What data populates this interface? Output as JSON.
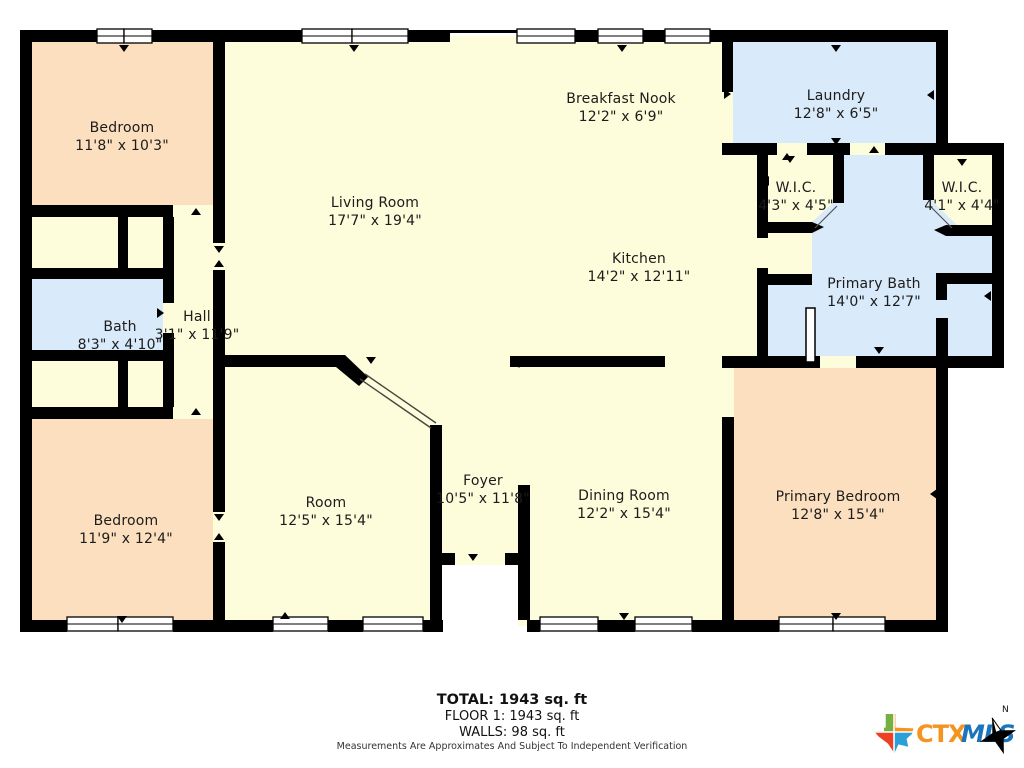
{
  "floorplan": {
    "rooms": [
      {
        "name": "Bedroom",
        "dims": "11'8\" x 10'3\""
      },
      {
        "name": "Living Room",
        "dims": "17'7\" x 19'4\""
      },
      {
        "name": "Breakfast Nook",
        "dims": "12'2\" x 6'9\""
      },
      {
        "name": "Laundry",
        "dims": "12'8\" x 6'5\""
      },
      {
        "name": "W.I.C.",
        "dims": "4'3\" x 4'5\""
      },
      {
        "name": "W.I.C.",
        "dims": "4'1\" x 4'4\""
      },
      {
        "name": "Kitchen",
        "dims": "14'2\" x 12'11\""
      },
      {
        "name": "Primary Bath",
        "dims": "14'0\" x 12'7\""
      },
      {
        "name": "Bath",
        "dims": "8'3\" x 4'10\""
      },
      {
        "name": "Hall",
        "dims": "3'1\" x 11'9\""
      },
      {
        "name": "Bedroom",
        "dims": "11'9\" x 12'4\""
      },
      {
        "name": "Room",
        "dims": "12'5\" x 15'4\""
      },
      {
        "name": "Foyer",
        "dims": "10'5\" x 11'8\""
      },
      {
        "name": "Dining Room",
        "dims": "12'2\" x 15'4\""
      },
      {
        "name": "Primary Bedroom",
        "dims": "12'8\" x 15'4\""
      }
    ],
    "footer": {
      "total": "TOTAL: 1943 sq. ft",
      "floor": "FLOOR 1: 1943 sq. ft",
      "walls": "WALLS: 98 sq. ft",
      "disclaimer": "Measurements Are Approximates And Subject To Independent Verification"
    },
    "logo": {
      "ctx": "CTX",
      "mls": "MLS",
      "north": "N"
    },
    "colors": {
      "room_cream": "#fdfcdb",
      "room_peach": "#fcdfbe",
      "room_blue": "#d9eafa",
      "wall": "#000000",
      "text": "#1c1c1c",
      "logo_orange": "#f6921e",
      "logo_blue": "#1b75bb",
      "logo_green": "#76b043",
      "logo_red": "#ee4023",
      "logo_teal": "#2a9fd8"
    }
  }
}
